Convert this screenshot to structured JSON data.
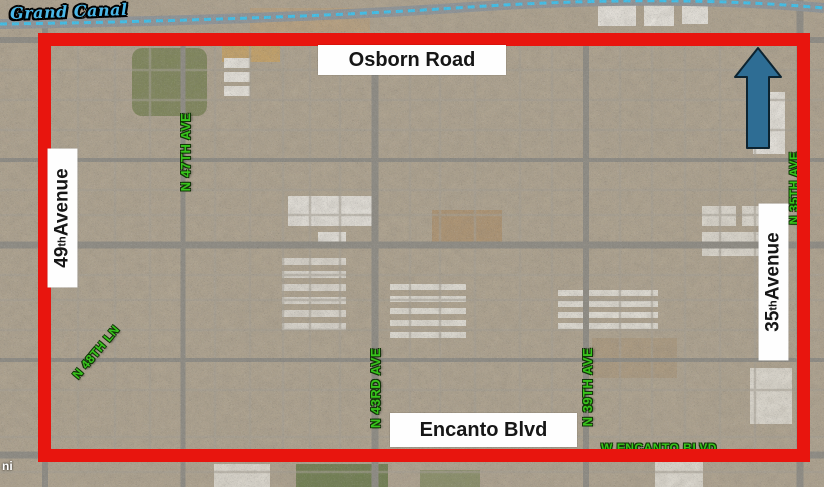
{
  "figure": {
    "type": "satellite-map-study-area",
    "watermark": "ni"
  },
  "labels": {
    "grand_canal": "Grand Canal",
    "osborn": "Osborn Road",
    "encanto": "Encanto Blvd",
    "ave49": {
      "num": "49",
      "ord": "th",
      "word": " Avenue"
    },
    "ave35": {
      "num": "35",
      "ord": "th",
      "word": " Avenue"
    },
    "green": [
      {
        "text": "N 47TH AVE"
      },
      {
        "text": "N 48TH LN"
      },
      {
        "text": "N 43RD AVE"
      },
      {
        "text": "N 39TH AVE"
      },
      {
        "text": "N 35TH AVE"
      },
      {
        "text": "W ENCANTO BLVD"
      }
    ]
  },
  "icons": {
    "north_arrow": "north-arrow-up"
  },
  "colors": {
    "boundary": "#e8150e",
    "green": "#38c41c",
    "arrow": "#2e6d94",
    "canalText": "#4ab7e8"
  }
}
